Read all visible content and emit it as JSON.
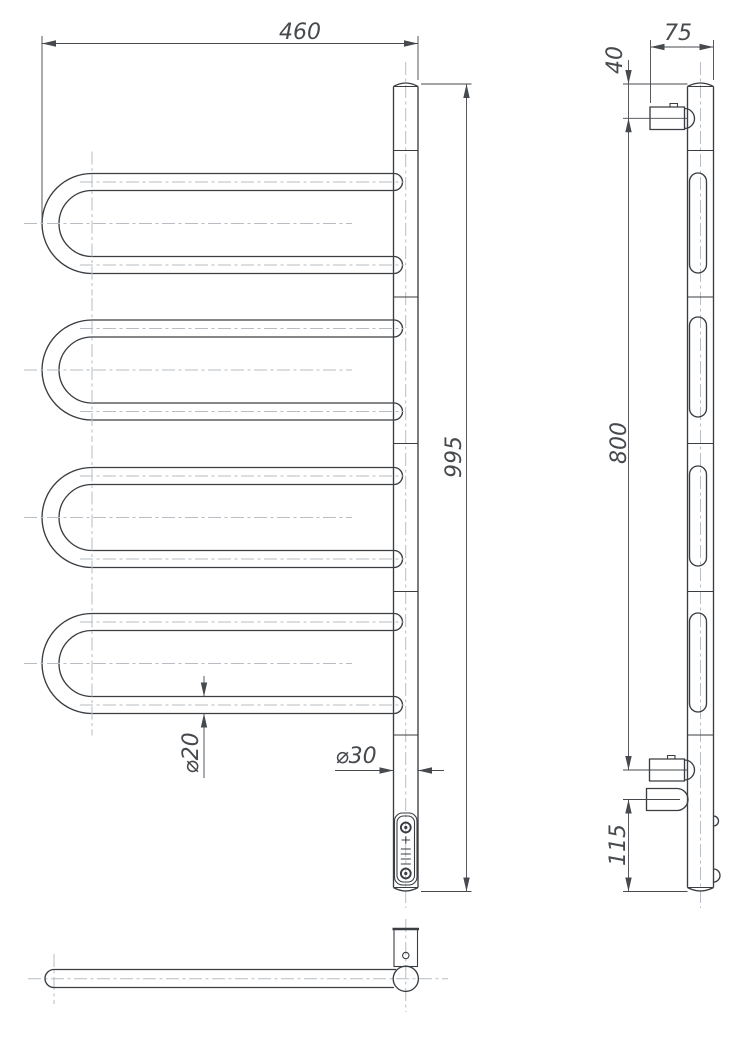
{
  "drawing": {
    "front_view": {
      "overall_width": "460",
      "overall_height": "995",
      "tube_diameter": "⌀20",
      "column_diameter": "⌀30"
    },
    "side_view": {
      "depth": "75",
      "top_bracket_offset": "40",
      "bracket_span": "800",
      "bottom_bracket_offset": "115"
    },
    "colors": {
      "line": "#3a3e42",
      "centerline": "#b7bdc3",
      "dimension": "#46494d",
      "background": "#ffffff"
    },
    "icons": {
      "brand_badge": "brand-badge-icon"
    }
  }
}
